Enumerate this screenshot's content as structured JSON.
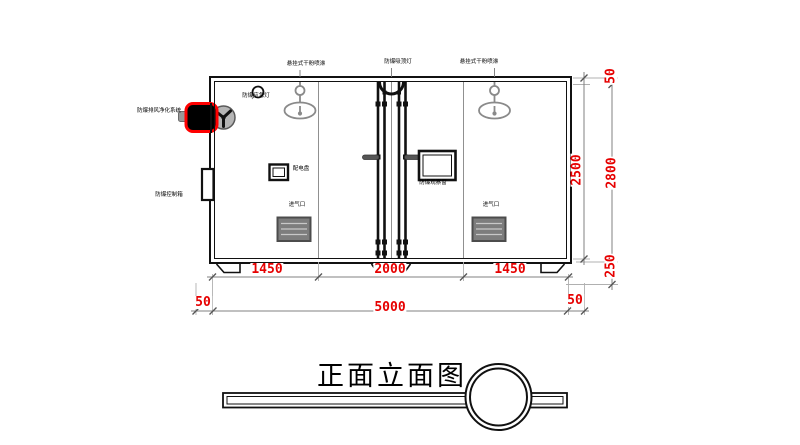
{
  "title": "正面立面图",
  "labels": {
    "sprinkler_left": "悬挂式干粉喷淋",
    "ceiling_lamp": "防爆吸顶灯",
    "sprinkler_right": "悬挂式干粉喷淋",
    "emergency_lamp": "防爆应急灯",
    "purifier_system": "防爆排风净化系统",
    "control_box": "防爆控制箱",
    "power_panel": "配电盘",
    "observation_window": "防爆观察窗",
    "air_inlet_left": "进气口",
    "air_inlet_right": "进气口"
  },
  "dimensions": {
    "bottom_row1": [
      "1450",
      "2000",
      "1450"
    ],
    "bottom_row2": [
      "50",
      "5000",
      "50"
    ],
    "right_inner_height": "2500",
    "right_top_offset": "50",
    "right_total_height": "2800",
    "right_base_height": "250"
  },
  "colors": {
    "dimension_text": "#e60000",
    "highlight_outline": "#ff0000",
    "drawing_line": "#111111",
    "secondary_line": "#909090"
  }
}
